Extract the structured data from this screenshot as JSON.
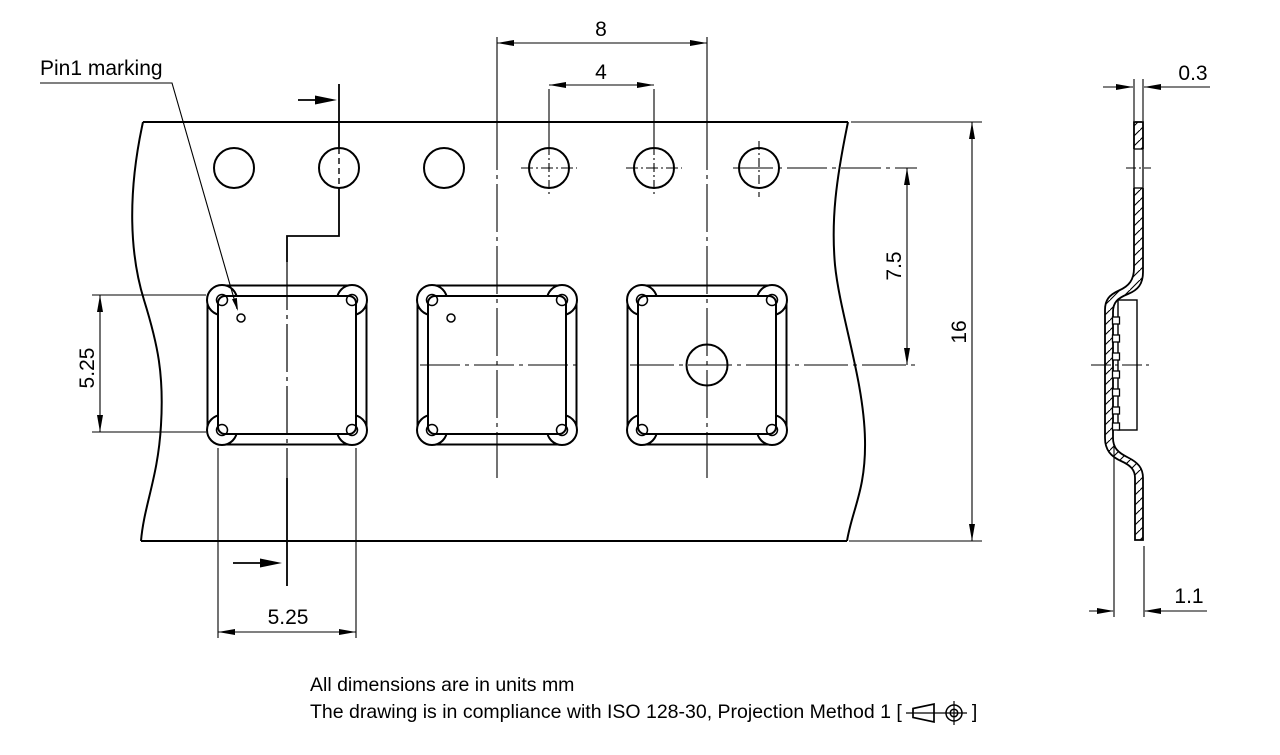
{
  "drawing": {
    "pin1_label": "Pin1 marking",
    "dims": {
      "pocket_pitch": "8",
      "hole_pitch": "4",
      "hole_to_pocket_center": "7.5",
      "tape_width": "16",
      "pocket_height": "5.25",
      "pocket_width": "5.25",
      "tape_thickness": "0.3",
      "pocket_depth": "1.1"
    },
    "notes": {
      "line1": "All dimensions are in units mm",
      "line2_prefix": "The drawing is in compliance with ISO 128-30, Projection Method 1 [",
      "line2_suffix": "]"
    }
  }
}
